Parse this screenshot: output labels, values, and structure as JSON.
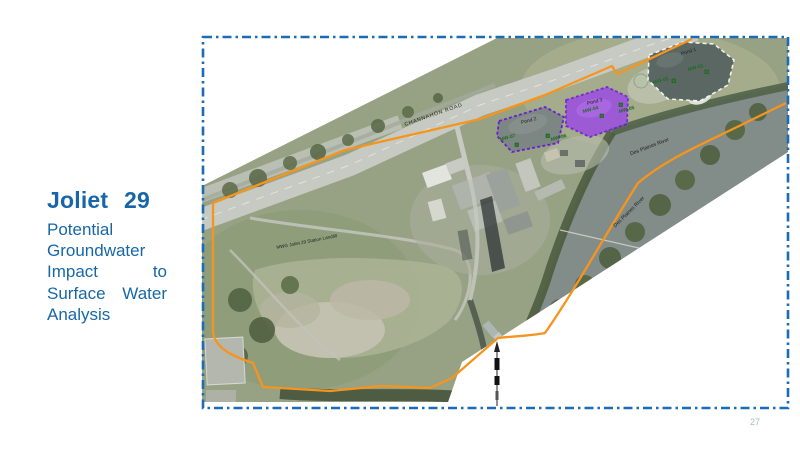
{
  "slide": {
    "title_word": "Joliet",
    "title_number": "29",
    "subtitle": "Potential Groundwater Impact to Surface Water Analysis",
    "page_number": "27"
  },
  "map": {
    "road_label": "CHANNAHON ROAD",
    "river_label_upper": "Des Plaines River",
    "river_label_lower": "Des Plaines River",
    "landfill_label": "MWG Joliet 29 Station Landfill",
    "ponds": [
      {
        "name": "Pond 1"
      },
      {
        "name": "Pond 2"
      },
      {
        "name": "Pond 3"
      }
    ],
    "wells": [
      {
        "id": "MW-01"
      },
      {
        "id": "MW-02"
      },
      {
        "id": "MW-04"
      },
      {
        "id": "MW-05"
      },
      {
        "id": "MW-06"
      },
      {
        "id": "MW-07"
      }
    ],
    "colors": {
      "title_blue": "#1767A8",
      "border_blue": "#1C6BB5",
      "boundary_orange": "#F7941D",
      "pond_purple": "#9B4FE0",
      "well_green": "#1E6E1E"
    }
  }
}
